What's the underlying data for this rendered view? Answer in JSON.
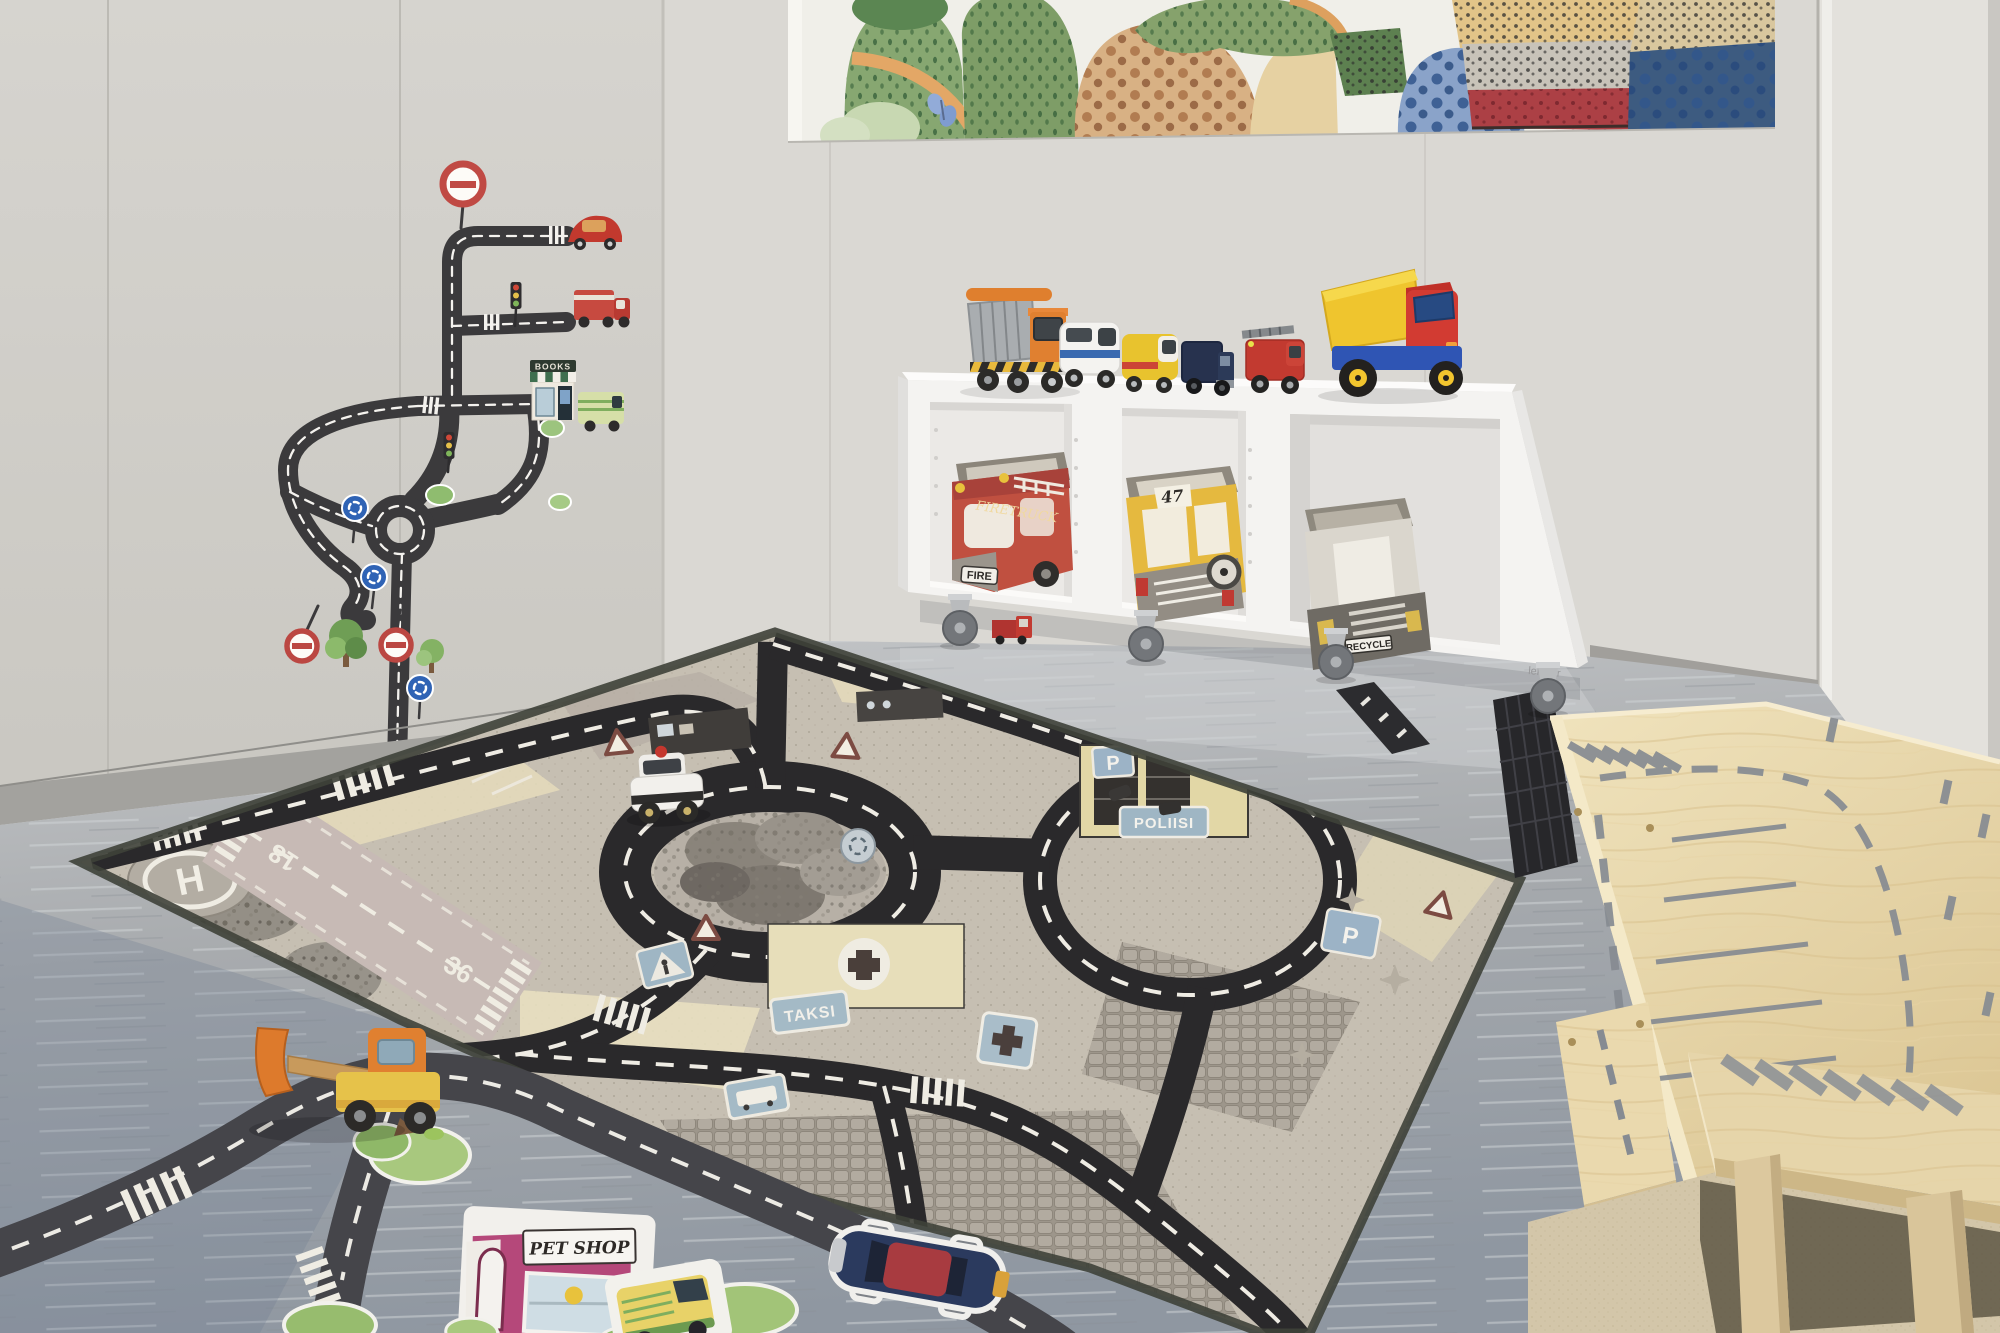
{
  "scene": {
    "setting": "Children's playroom with traffic-themed play rug, toy vehicle shelf, road wall decals, watercolor mural and wooden play furniture"
  },
  "mural": {
    "style": "watercolor landscape with dotted hills"
  },
  "wall_decal": {
    "books_shop_sign": "BOOKS"
  },
  "shelf": {
    "brand_label": "lekolar",
    "toys_on_top": [
      "orange dump truck",
      "white police van",
      "yellow ambulance",
      "navy truck",
      "red fire engine",
      "red and yellow dump truck"
    ],
    "bins": [
      {
        "label": "FIRETRUCK",
        "plate": "FIRE"
      },
      {
        "number": "47"
      },
      {
        "plate": "RECYCLE"
      }
    ]
  },
  "rug": {
    "police_sign": "POLIISI",
    "taxi_sign": "TAKSI",
    "helipad_letter": "H",
    "runway_near": "36",
    "runway_far": "18",
    "parking_letter": "P"
  },
  "floor": {
    "pet_shop_sign": "PET SHOP"
  },
  "colors": {
    "wall": "#d7d5d0",
    "floor": "#a6a9ac",
    "rug_base": "#c6bfb2",
    "road": "#2a292b",
    "birch": "#e9d9b1",
    "shelf_white": "#f4f3f1",
    "sign_blue": "#9fb6c4"
  }
}
